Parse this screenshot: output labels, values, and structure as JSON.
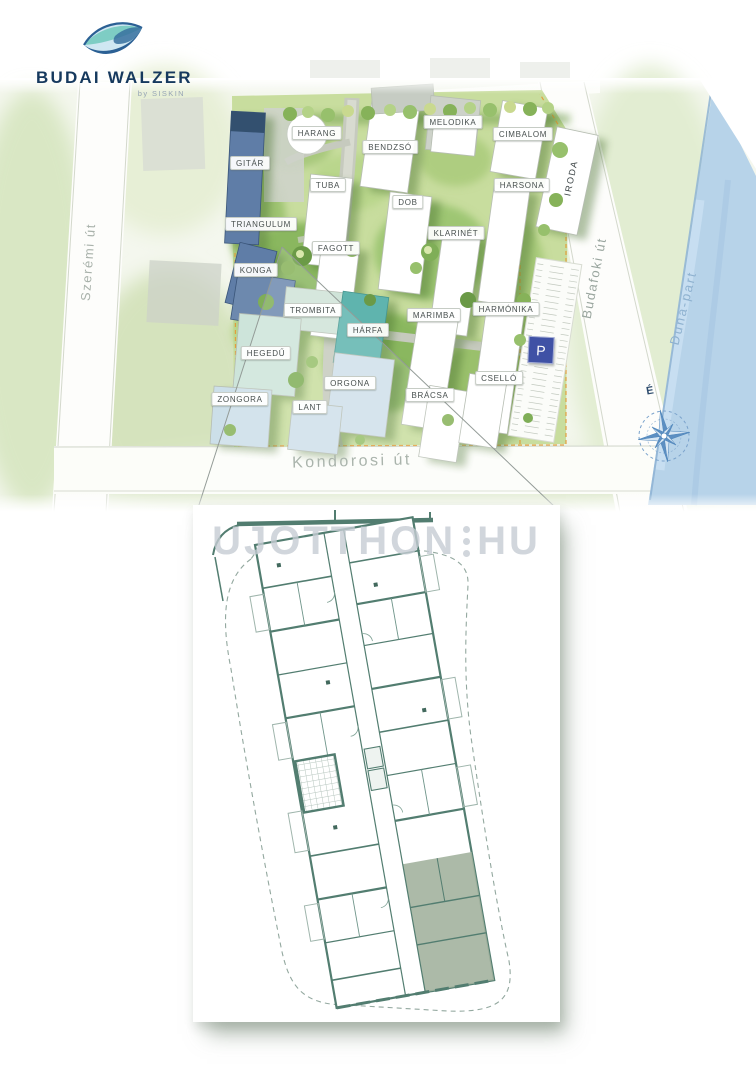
{
  "logo": {
    "brand": "BUDAI WALZER",
    "byline": "by SISKIN"
  },
  "map": {
    "buildings": [
      "HARANG",
      "BENDZSÓ",
      "MELODIKA",
      "CIMBALOM",
      "GITÁR",
      "TUBA",
      "HARSONA",
      "TRIANGULUM",
      "DOB",
      "KLARINÉT",
      "FAGOTT",
      "KONGA",
      "TROMBITA",
      "HÁRFA",
      "MARIMBA",
      "HARMÓNIKA",
      "HEGEDŰ",
      "ORGONA",
      "ZONGORA",
      "LANT",
      "BRÁCSA",
      "CSELLÓ",
      "IRODA"
    ],
    "streets": {
      "west": "Szerémi út",
      "east": "Budafoki út",
      "south": "Kondorosi út"
    },
    "river_label": "Duna-part",
    "compass_north_label": "É",
    "parking_badge": "P"
  },
  "floorplan": {
    "watermark_left": "UJOTTHON",
    "watermark_right": "HU"
  },
  "colors": {
    "brand_navy": "#16395e",
    "logo_teal": "#7ecdc4",
    "parking_blue": "#3f51a5",
    "site_boundary_orange": "#e39b3a",
    "plan_wall_teal": "#527d70",
    "river_blue": "#b7d3e9",
    "highlight_unit_sage": "#a3b29f"
  }
}
